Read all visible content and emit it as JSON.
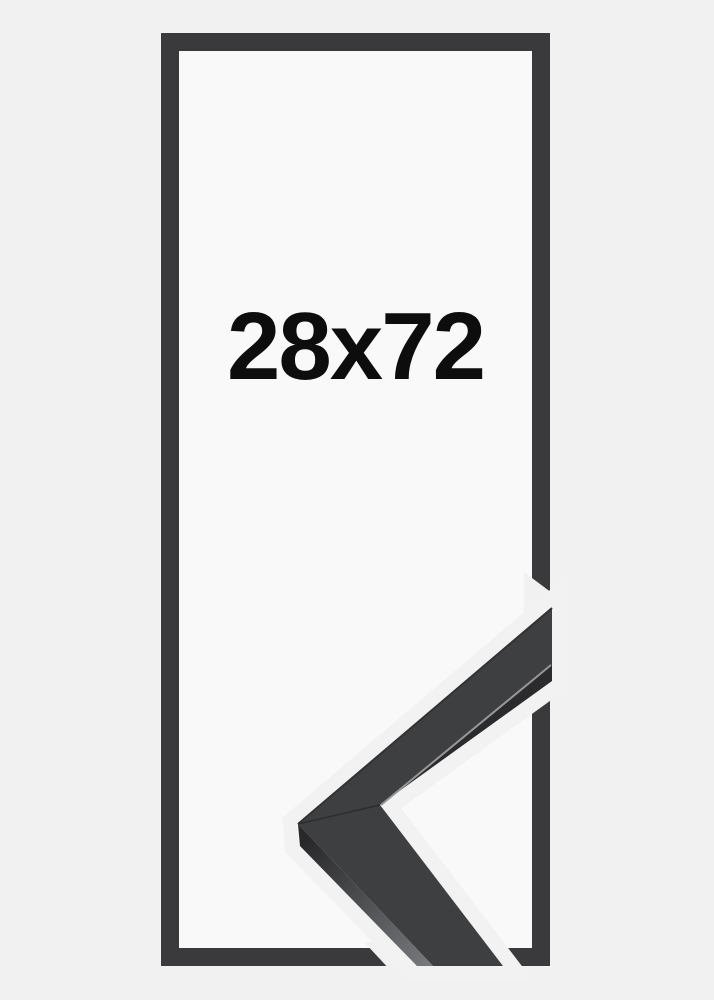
{
  "page": {
    "background_color": "#f1f1f2"
  },
  "product_image": {
    "size_label": "28x72",
    "label_color": "#0d0d0d",
    "frame_outline": {
      "bar_color": "#3a3a3c",
      "interior_color": "#f9f9fa"
    },
    "corner_sample": {
      "top_face_color": "#3e3f41",
      "inner_side_color": "#2b2b2d",
      "outer_side_dark_color": "#28282a",
      "outer_side_light_color": "#77797c",
      "edge_highlight_color": "#95979a",
      "outer_edge_shade_color": "#323234",
      "miter_seam_color": "#2d2d2f",
      "cutout_margin_color": "#f2f2f3"
    }
  }
}
